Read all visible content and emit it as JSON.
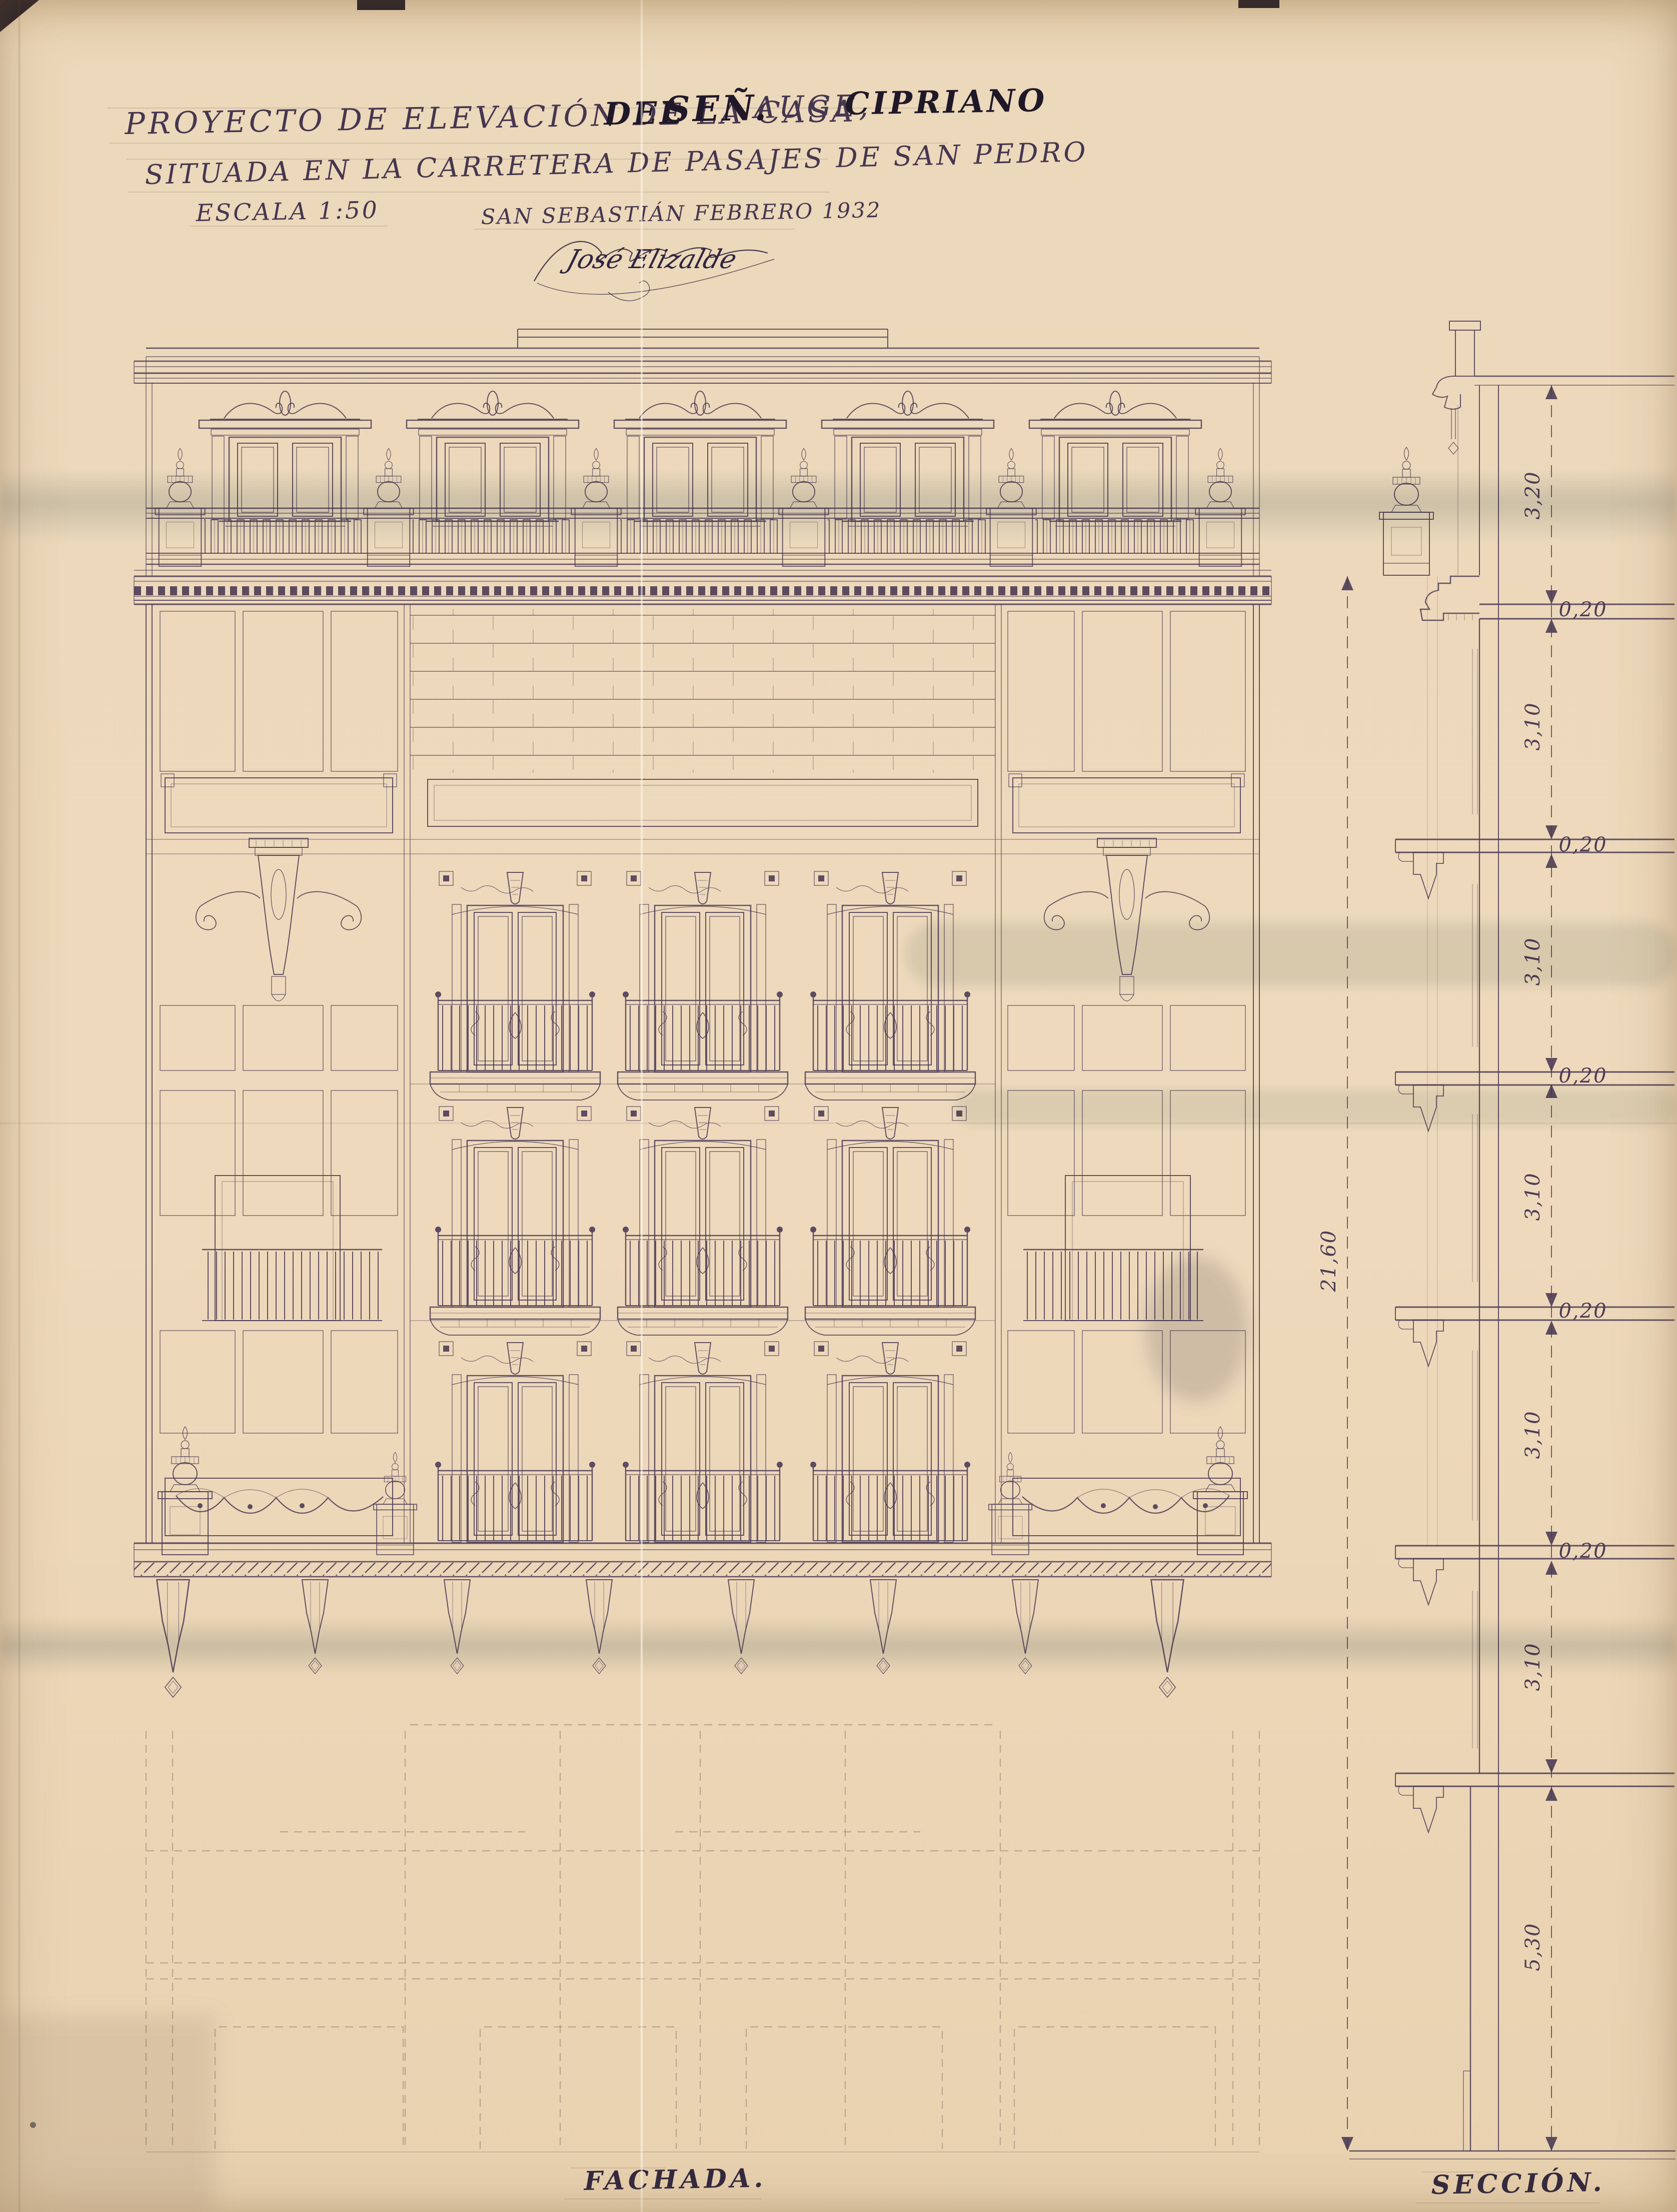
{
  "sheet": {
    "title_line1": {
      "segment_light": "PROYECTO DE ELEVACIÓN DE LA CASA",
      "segment_dark1": "DEL",
      "segment_dark2": "SEÑ.",
      "segment_light2": "AUGE,",
      "segment_dark3": "CIPRIANO"
    },
    "title_line2": "SITUADA EN LA CARRETERA DE PASAJES DE SAN PEDRO",
    "scale_note": "ESCALA 1:50",
    "place_date": "SAN SEBASTIÁN FEBRERO 1932",
    "signature": "José Elizalde",
    "drawing_labels": {
      "left": "FACHADA.",
      "right": "SECCIÓN."
    }
  },
  "section_dimensions": {
    "total_height": "21,60",
    "chain": [
      "3,20",
      "0,20",
      "3,10",
      "0,20",
      "3,10",
      "0,20",
      "3,10",
      "0,20",
      "3,10",
      "0,20",
      "3,10",
      "5,30"
    ]
  },
  "colors": {
    "paper": "#ecd8ba",
    "ink": "#4d3c55",
    "ink_dark": "#211a2c",
    "pencil": "#a28f7c",
    "stain_blue": "#94a7ab"
  }
}
